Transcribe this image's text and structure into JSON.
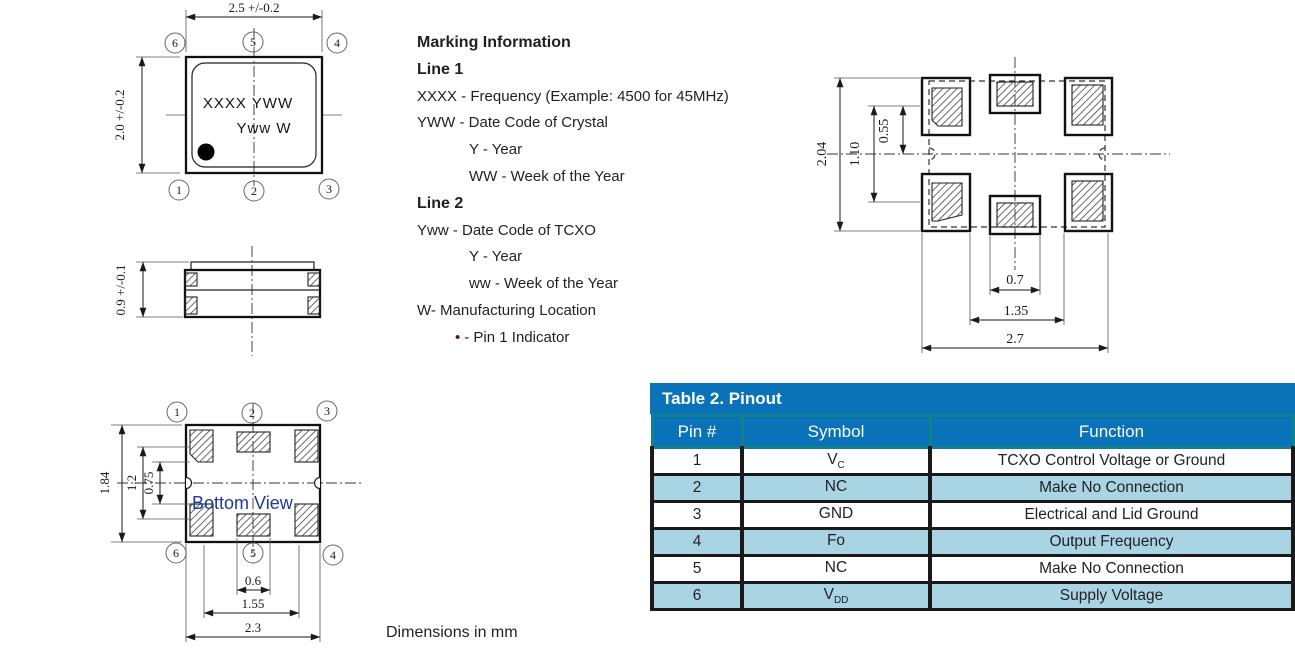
{
  "top_view": {
    "dim_width": "2.5 +/-0.2",
    "dim_height": "2.0 +/-0.2",
    "marking_line1": "XXXX YWW",
    "marking_line2": "Yww W",
    "pin_tl": "6",
    "pin_tc": "5",
    "pin_tr": "4",
    "pin_bl": "1",
    "pin_bc": "2",
    "pin_br": "3"
  },
  "side_view": {
    "dim_height": "0.9 +/-0.1"
  },
  "bottom_view": {
    "label": "Bottom View",
    "pin_tl": "1",
    "pin_tc": "2",
    "pin_tr": "3",
    "pin_bl": "6",
    "pin_bc": "5",
    "pin_br": "4",
    "dim_outer_height": "1.84",
    "dim_pad_span": "1.2",
    "dim_pad_gap": "0.75",
    "dim_pad_width": "0.6",
    "dim_pad_pitch": "1.55",
    "dim_outer_width": "2.3"
  },
  "land_pattern": {
    "dim_outer_height": "2.04",
    "dim_row_pitch": "1.10",
    "dim_half_pitch": "0.55",
    "dim_pad_width": "0.7",
    "dim_col_gap": "1.35",
    "dim_outer_width": "2.7"
  },
  "marking_info": {
    "title": "Marking Information",
    "lines": [
      "Line 1",
      "XXXX - Frequency (Example: 4500 for 45MHz)",
      "YWW - Date Code of Crystal",
      "Y - Year",
      "WW - Week of the Year",
      "Line 2",
      "Yww - Date Code of TCXO",
      "Y - Year",
      "ww - Week of the Year",
      "W- Manufacturing Location",
      "- Pin 1 Indicator"
    ],
    "bullet": "•"
  },
  "footer": {
    "dimensions_note": "Dimensions in mm"
  },
  "pinout_table": {
    "title": "Table 2. Pinout",
    "headers": {
      "pin": "Pin #",
      "symbol": "Symbol",
      "function": "Function"
    },
    "rows": [
      {
        "pin": "1",
        "symbol": "V",
        "symbol_sub": "C",
        "function": "TCXO Control Voltage or Ground"
      },
      {
        "pin": "2",
        "symbol": "NC",
        "symbol_sub": "",
        "function": "Make No Connection"
      },
      {
        "pin": "3",
        "symbol": "GND",
        "symbol_sub": "",
        "function": "Electrical and Lid Ground"
      },
      {
        "pin": "4",
        "symbol": "Fo",
        "symbol_sub": "",
        "function": "Output Frequency"
      },
      {
        "pin": "5",
        "symbol": "NC",
        "symbol_sub": "",
        "function": "Make No Connection"
      },
      {
        "pin": "6",
        "symbol": "V",
        "symbol_sub": "DD",
        "function": "Supply Voltage"
      }
    ]
  }
}
